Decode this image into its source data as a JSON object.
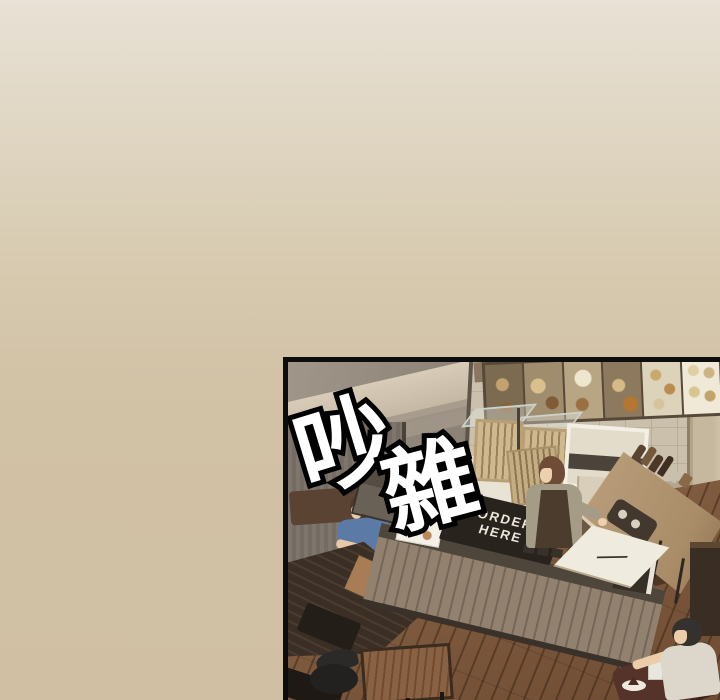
{
  "page": {
    "type": "webtoon-episode-view",
    "background_top_color": "#e8e1d5",
    "background_bottom_color": "#d0bfa3"
  },
  "panel": {
    "border_color": "#0d0d0d",
    "sfx": {
      "text": "吵雜",
      "char1": "吵",
      "char2": "雜",
      "fill_color": "#ffffff",
      "outline_color": "#000000"
    },
    "order_sign": {
      "line1": "ORDER",
      "line2": "HERE",
      "background": "#29231d",
      "text_color": "#ece7dc"
    },
    "scene": {
      "floor_color": "#7b573c",
      "wall_color": "#8e8478",
      "tile_wall_color": "#cbc0ab",
      "counter_wood_color": "#93816f",
      "booth_table_color": "#3b2f25",
      "menu_board_frame_color": "#57493a"
    }
  }
}
